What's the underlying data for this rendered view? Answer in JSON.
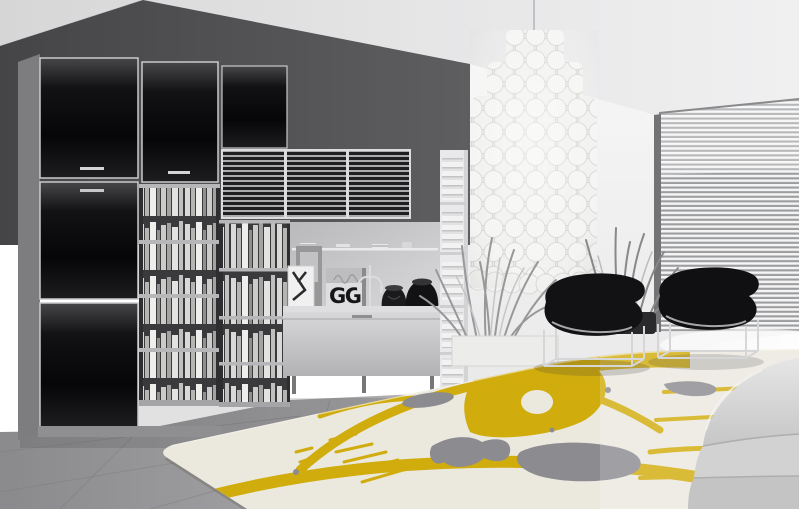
{
  "scene": {
    "type": "interior-photograph",
    "description": "Modern living room photographed in black and white with a selective-colour cream rug bearing a yellow and grey poppy design",
    "cover_text": "GG",
    "objects": {
      "wall_unit": "black gloss wall unit with bookshelves, louvered cabinets, display alcove and low sideboard",
      "chandelier": "tiered capiz shell pendant chandelier",
      "chairs": "two black moulded lounge chairs on chrome wire frames",
      "plants": "potted ornamental grasses",
      "window": "full-height window with horizontal venetian blinds",
      "sofa": "white fabric sofa corner",
      "rug": "cream rug with yellow poppy outline and grey blotches"
    },
    "colors": {
      "accent_yellow": "#d1ac0d",
      "rug_base": "#ebe8de",
      "rug_grey": "#8b8b90",
      "cabinet_black": "#0a0a0c",
      "wall_dark": "#505052",
      "wall_light": "#f2f2f2",
      "ceiling": "#e4e4e4",
      "floor": "#9a9a9d"
    }
  }
}
